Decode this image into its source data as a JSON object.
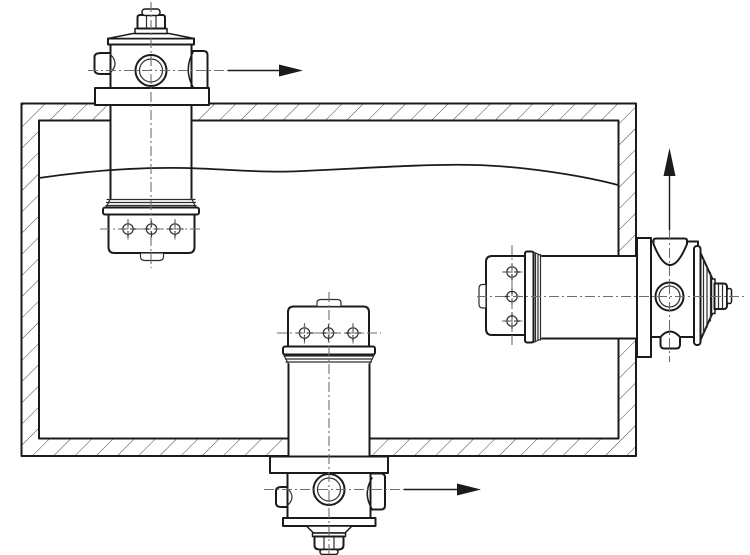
{
  "diagram": {
    "kind": "engineering-section-drawing",
    "subject": "hydraulic-reservoir-with-three-return-filter-mounting-positions",
    "colors": {
      "bg": "#ffffff",
      "fill": "#ffffff",
      "line": "#1b1b1b",
      "thin": "#2d2d2d",
      "hatch": "#454545",
      "centerline": "#6e6e6e"
    },
    "components": [
      {
        "id": "reservoir-tank",
        "name": "tank-section-with-hatched-walls"
      },
      {
        "id": "fluid-level",
        "name": "fluid-level-line"
      },
      {
        "id": "top-filter",
        "name": "tank-top-mounted-filter",
        "outlet_arrow": "right"
      },
      {
        "id": "bottom-filter",
        "name": "tank-bottom-mounted-filter",
        "outlet_arrow": "right"
      },
      {
        "id": "side-filter",
        "name": "tank-side-mounted-filter",
        "outlet_arrow": "up"
      }
    ],
    "arrows": [
      {
        "id": "top-outlet-arrow",
        "direction": "right"
      },
      {
        "id": "bottom-outlet-arrow",
        "direction": "right"
      },
      {
        "id": "side-outlet-arrow",
        "direction": "up"
      }
    ]
  }
}
